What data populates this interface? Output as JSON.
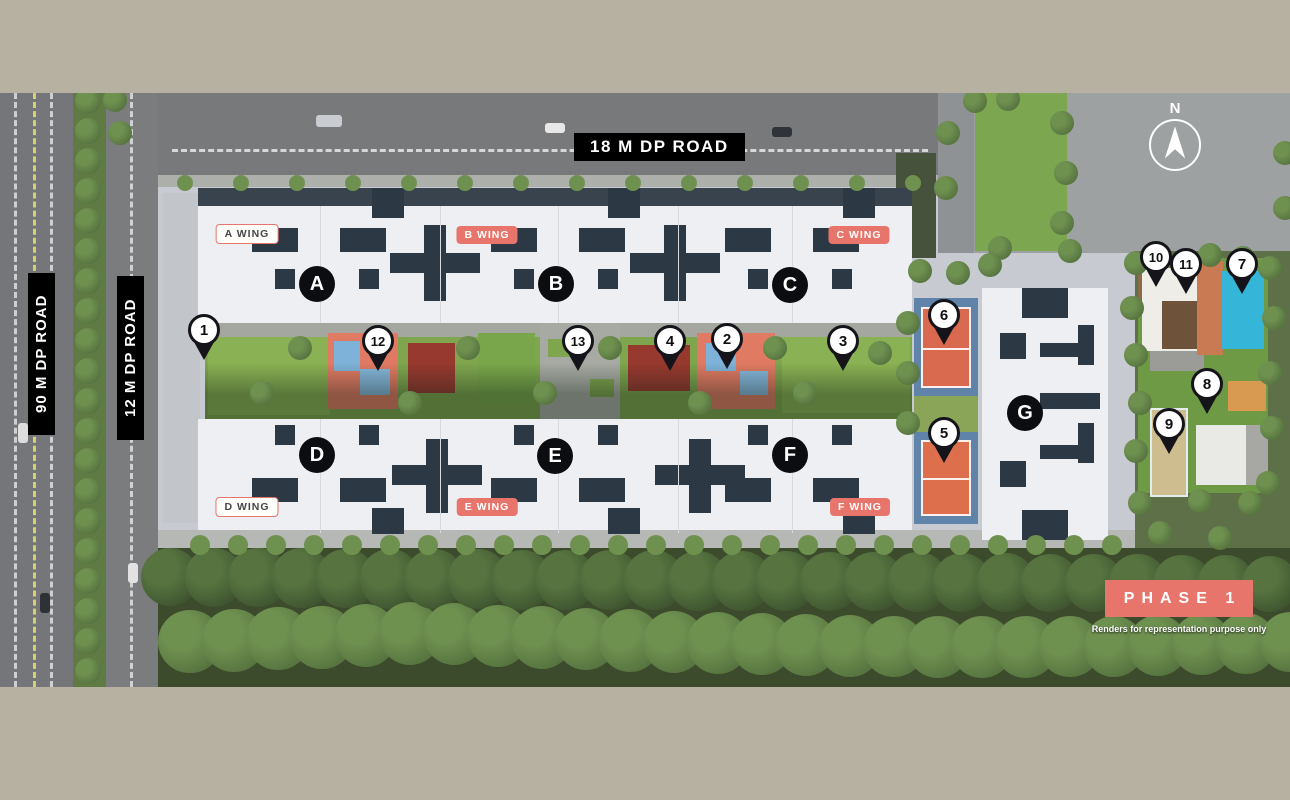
{
  "title": "Site Master Plan - Phase 1",
  "roads": {
    "top_label": "18 M DP ROAD",
    "left_outer_label": "90 M DP ROAD",
    "left_inner_label": "12 M DP ROAD"
  },
  "compass_label": "N",
  "phase_label": "PHASE 1",
  "disclaimer": "Renders for representation purpose only",
  "colors": {
    "accent_salmon": "#e8756b",
    "label_black": "#000000",
    "pin_outline": "#14141a",
    "court_orange": "#d96a4f",
    "court_blue": "#5f83a9",
    "pool_blue": "#35b5d8",
    "border_tan": "#b6b1a0"
  },
  "wings": [
    {
      "label": "A WING",
      "style": "outline",
      "x": 247,
      "y": 141
    },
    {
      "label": "B WING",
      "style": "filled",
      "x": 487,
      "y": 142
    },
    {
      "label": "C WING",
      "style": "filled",
      "x": 859,
      "y": 142
    },
    {
      "label": "D WING",
      "style": "outline",
      "x": 247,
      "y": 414
    },
    {
      "label": "E WING",
      "style": "filled",
      "x": 487,
      "y": 414
    },
    {
      "label": "F WING",
      "style": "filled",
      "x": 860,
      "y": 414
    }
  ],
  "buildings": [
    {
      "letter": "A",
      "x": 317,
      "y": 191
    },
    {
      "letter": "B",
      "x": 556,
      "y": 191
    },
    {
      "letter": "C",
      "x": 790,
      "y": 192
    },
    {
      "letter": "D",
      "x": 317,
      "y": 362
    },
    {
      "letter": "E",
      "x": 555,
      "y": 363
    },
    {
      "letter": "F",
      "x": 790,
      "y": 362
    },
    {
      "letter": "G",
      "x": 1025,
      "y": 320
    }
  ],
  "markers": [
    {
      "number": "1",
      "x": 204,
      "y": 267
    },
    {
      "number": "2",
      "x": 727,
      "y": 276
    },
    {
      "number": "3",
      "x": 843,
      "y": 278
    },
    {
      "number": "4",
      "x": 670,
      "y": 278
    },
    {
      "number": "5",
      "x": 944,
      "y": 370
    },
    {
      "number": "6",
      "x": 944,
      "y": 252
    },
    {
      "number": "7",
      "x": 1242,
      "y": 201
    },
    {
      "number": "8",
      "x": 1207,
      "y": 321
    },
    {
      "number": "9",
      "x": 1169,
      "y": 361
    },
    {
      "number": "10",
      "x": 1156,
      "y": 194
    },
    {
      "number": "11",
      "x": 1186,
      "y": 201
    },
    {
      "number": "12",
      "x": 378,
      "y": 278
    },
    {
      "number": "13",
      "x": 578,
      "y": 278
    }
  ]
}
